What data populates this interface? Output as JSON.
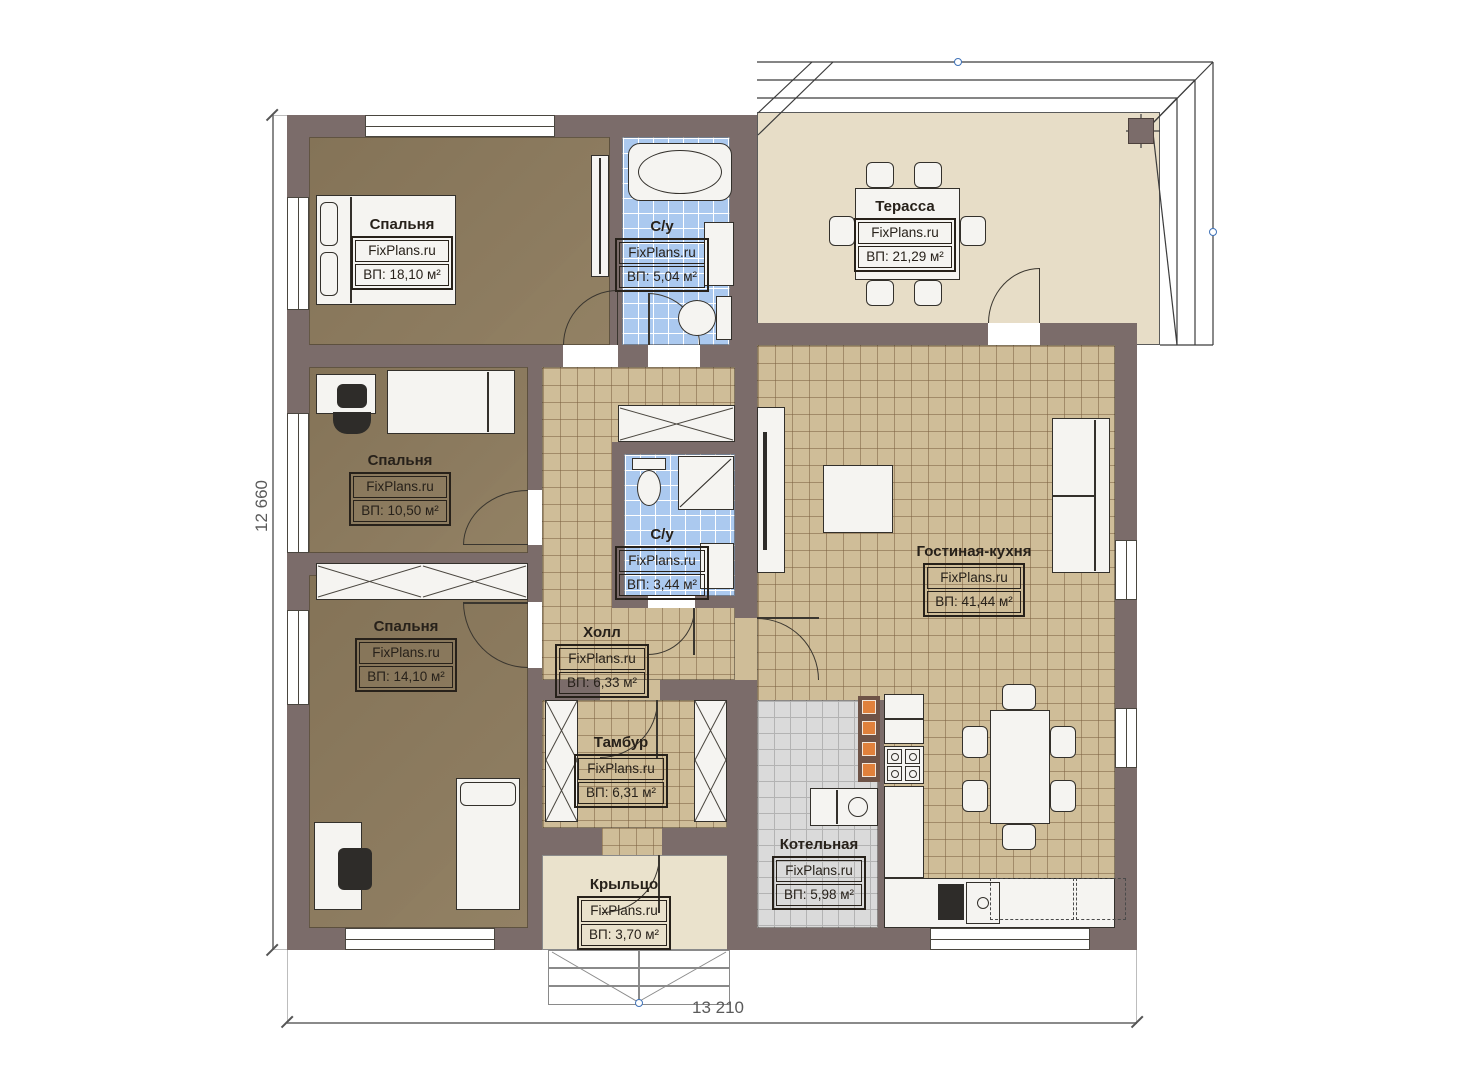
{
  "brand": "FixPlans.ru",
  "rooms": [
    {
      "id": "bedroom-1",
      "name": "Спальня",
      "area": "ВП: 18,10 м²"
    },
    {
      "id": "bathroom-1",
      "name": "С/у",
      "area": "ВП: 5,04 м²"
    },
    {
      "id": "terrace",
      "name": "Терасса",
      "area": "ВП: 21,29 м²"
    },
    {
      "id": "bedroom-2",
      "name": "Спальня",
      "area": "ВП: 10,50 м²"
    },
    {
      "id": "bathroom-2",
      "name": "С/у",
      "area": "ВП: 3,44 м²"
    },
    {
      "id": "living-kitchen",
      "name": "Гостиная-кухня",
      "area": "ВП: 41,44 м²"
    },
    {
      "id": "bedroom-3",
      "name": "Спальня",
      "area": "ВП: 14,10 м²"
    },
    {
      "id": "hall",
      "name": "Холл",
      "area": "ВП: 6,33 м²"
    },
    {
      "id": "vestibule",
      "name": "Тамбур",
      "area": "ВП: 6,31 м²"
    },
    {
      "id": "boiler-room",
      "name": "Котельная",
      "area": "ВП: 5,98 м²"
    },
    {
      "id": "porch",
      "name": "Крыльцо",
      "area": "ВП: 3,70 м²"
    }
  ],
  "dimensions": {
    "width_mm": "13 210",
    "height_mm": "12 660"
  },
  "colors": {
    "wall": "#7b6c6a",
    "bedroom_floor": "#8c7a5c",
    "tile_tan": "#cfbd98",
    "tile_blue": "#abc9ef",
    "tile_gray": "#dadada",
    "terrace_floor": "#e7ddc7",
    "accent_orange": "#e0813c"
  }
}
